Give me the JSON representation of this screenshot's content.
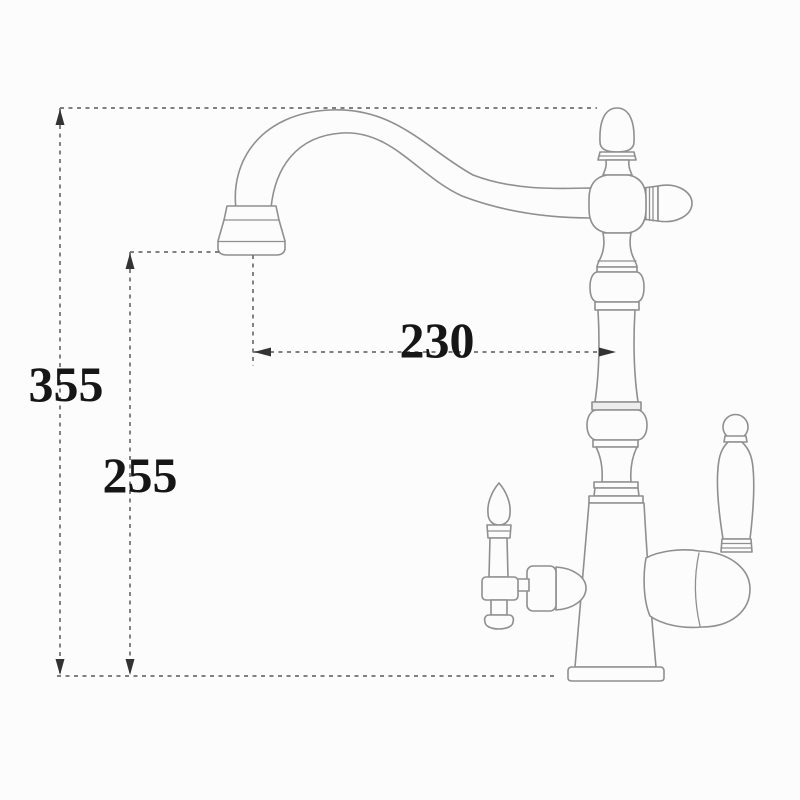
{
  "labels": {
    "total_height": "355",
    "spout_outlet_height": "255",
    "spout_reach": "230"
  },
  "colors": {
    "background": "#fcfcfc",
    "outline": "#8f8f8f",
    "dimension_line": "#6e6e6e",
    "arrow": "#333333",
    "text": "#161616"
  }
}
